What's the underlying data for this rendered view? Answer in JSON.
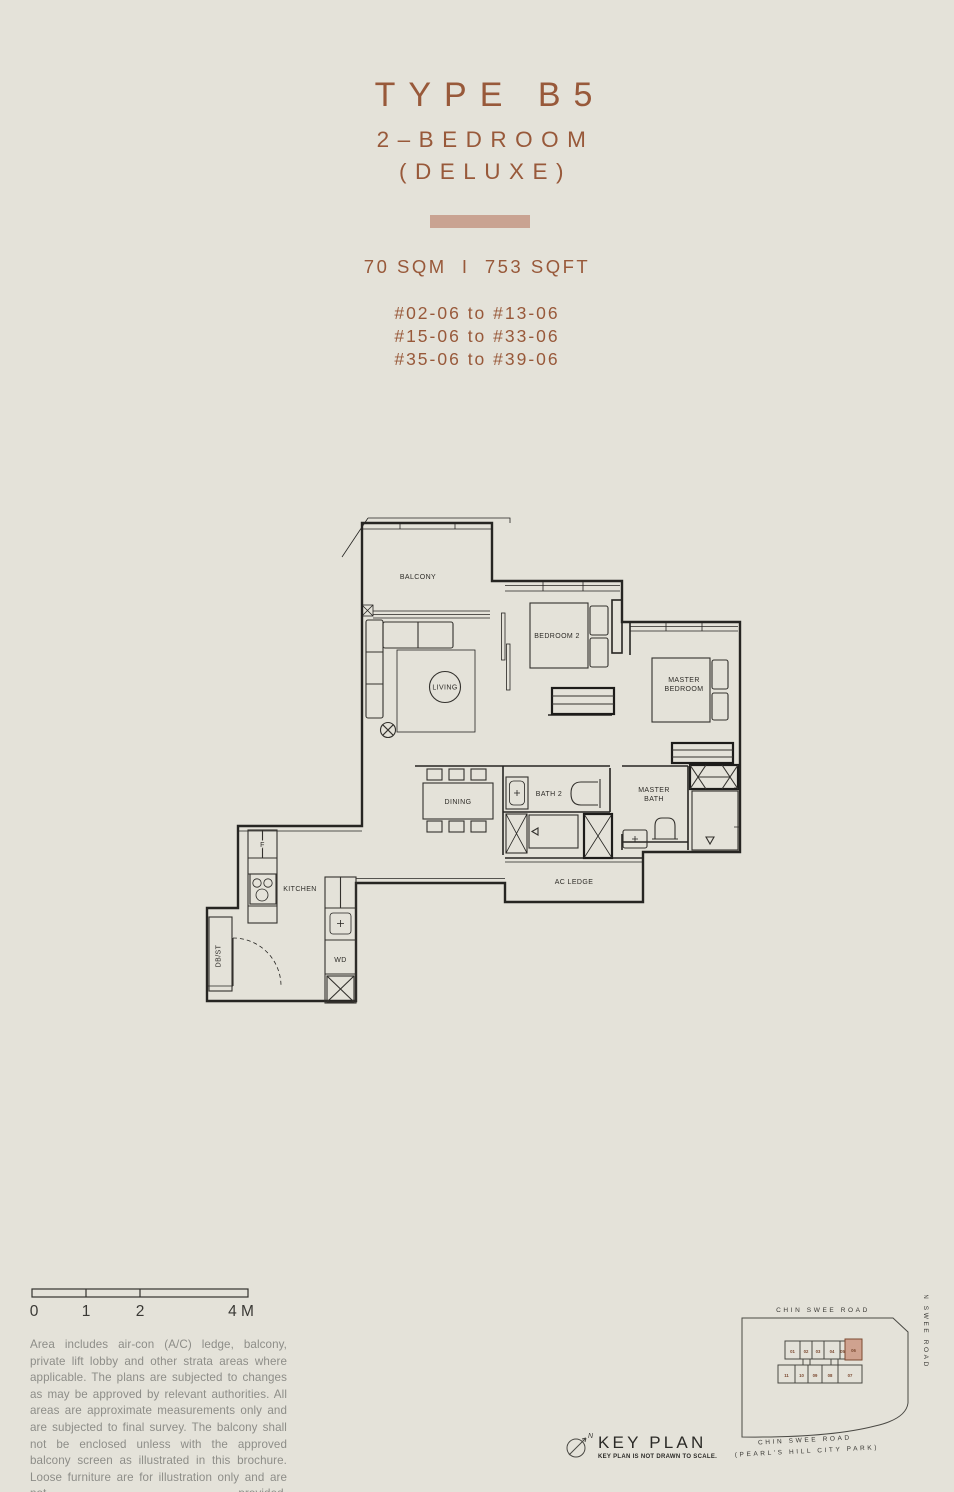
{
  "page": {
    "background": "#e4e2d9",
    "accent_color": "#c9a392",
    "title_color": "#98593a"
  },
  "header": {
    "title": "TYPE B5",
    "subtitle_line1": "2–BEDROOM",
    "subtitle_line2": "(DELUXE)",
    "area_text": "70 SQM  I  753 SQFT",
    "unit_ranges": [
      "#02-06 to #13-06",
      "#15-06 to #33-06",
      "#35-06 to #39-06"
    ]
  },
  "floor_plan": {
    "labels": {
      "balcony": "BALCONY",
      "living": "LIVING",
      "bedroom2": "BEDROOM 2",
      "master_bedroom_line1": "MASTER",
      "master_bedroom_line2": "BEDROOM",
      "dining": "DINING",
      "bath2": "BATH 2",
      "master_bath_line1": "MASTER",
      "master_bath_line2": "BATH",
      "ac_ledge": "AC LEDGE",
      "kitchen": "KITCHEN",
      "fridge": "F",
      "washer_dryer": "WD",
      "db_store": "DB/ST"
    }
  },
  "scale_bar": {
    "labels": [
      "0",
      "1",
      "2",
      "4 M"
    ]
  },
  "disclaimer": "Area includes air-con (A/C) ledge, balcony, private lift lobby and other strata areas where applicable. The plans are subjected to changes as may be approved by relevant authorities. All areas are approximate measurements only and are subjected to final survey. The balcony shall not be enclosed unless with the approved balcony screen as illustrated in this brochure. Loose furniture are for illustration only and are not provided.",
  "key_plan": {
    "title": "KEY PLAN",
    "note": "KEY PLAN IS NOT DRAWN TO SCALE.",
    "compass_label": "N",
    "road_top": "CHIN SWEE ROAD",
    "road_right": "CHIN SWEE ROAD",
    "road_bottom_line1": "CHIN SWEE ROAD",
    "road_bottom_line2": "(PEARL'S HILL CITY PARK)",
    "units_top": [
      "01",
      "02",
      "03",
      "04",
      "05",
      "06"
    ],
    "units_bottom": [
      "11",
      "10",
      "09",
      "08",
      "07"
    ],
    "highlighted_unit": "06",
    "highlight_color": "#cfa28f"
  }
}
